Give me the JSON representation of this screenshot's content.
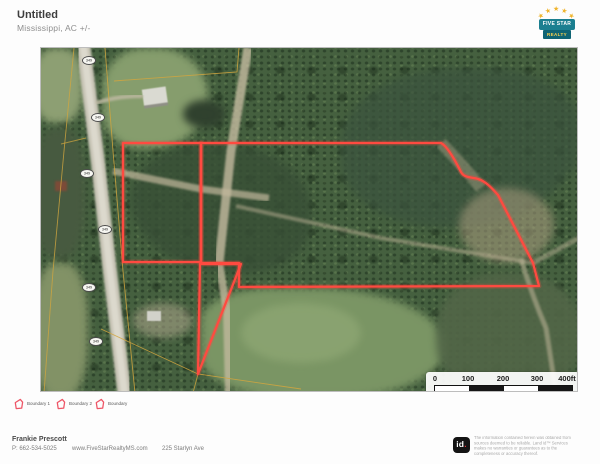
{
  "header": {
    "title": "Untitled",
    "subtitle": "Mississippi,  AC +/-"
  },
  "brand": {
    "logo_line1": "FIVE STAR",
    "logo_line2": "REALTY",
    "star_icon": "★"
  },
  "map": {
    "road_badges": [
      {
        "label": "349"
      },
      {
        "label": "349"
      },
      {
        "label": "349"
      },
      {
        "label": "349"
      },
      {
        "label": "349"
      },
      {
        "label": "349"
      }
    ],
    "boundary_color": "#ff4a40",
    "parcel_line_color": "#d2a63e",
    "boundaries": [
      {
        "name": "Boundary 1",
        "path": "M82,95 L160,95 L160,214 L82,214 Z"
      },
      {
        "name": "Boundary 2",
        "path": "M160,95 L400,95 C406,98 413,110 420,124 C423,130 431,129 437,131 C444,133 450,139 457,147 L492,215 L498,238 L198,239 L198,215 L160,215 Z"
      },
      {
        "name": "Boundary",
        "path": "M159,216 L200,216 L157,326 Z"
      }
    ],
    "scale_bar": {
      "labels": [
        "0",
        "100",
        "200",
        "300",
        "400ft"
      ]
    }
  },
  "legend": {
    "items": [
      {
        "label": "Boundary 1"
      },
      {
        "label": "Boundary 2"
      },
      {
        "label": "Boundary"
      }
    ]
  },
  "footer": {
    "agent_name": "Frankie Prescott",
    "agent_phone": "P: 662-534-5025",
    "website": "www.FiveStarRealtyMS.com",
    "address": "225 Starlyn Ave",
    "logo_text": "id",
    "logo_dot": ".",
    "disclaimer": "The information contained herein was obtained from sources deemed to be reliable. Land id™ Services makes no warranties or guarantees as to the completeness or accuracy thereof."
  }
}
